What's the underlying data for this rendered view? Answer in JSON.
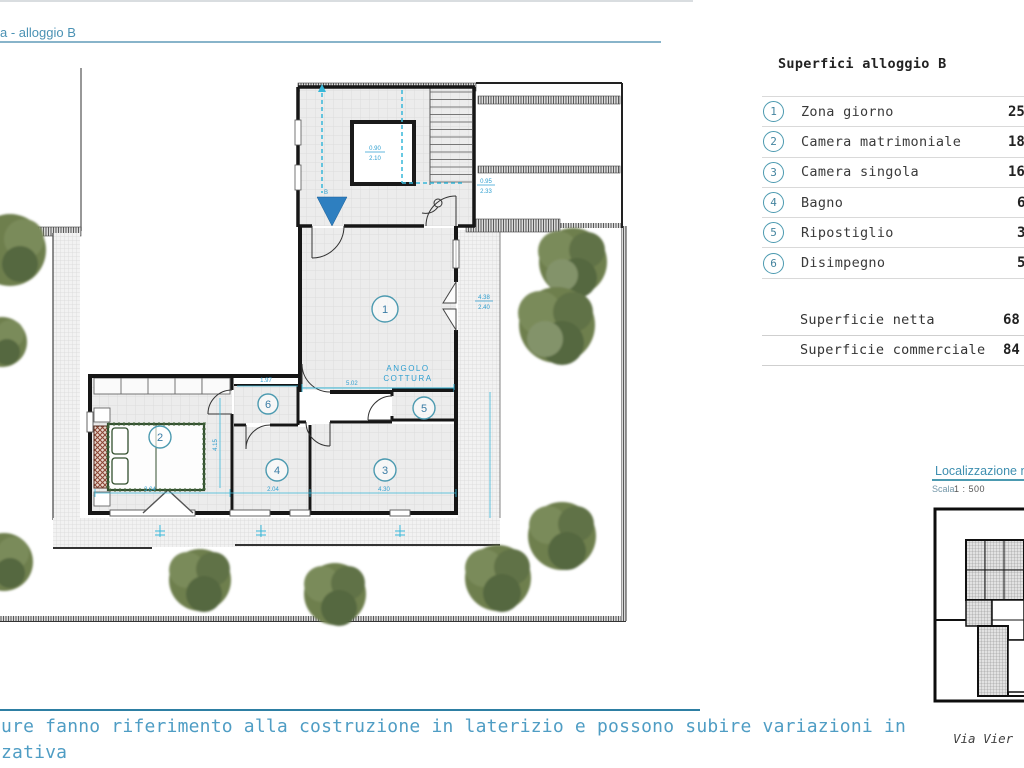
{
  "page": {
    "title": "a - alloggio B"
  },
  "panel": {
    "title": "Superfici alloggio B",
    "rows": [
      {
        "num": "1",
        "label": "Zona giorno",
        "value": "25"
      },
      {
        "num": "2",
        "label": "Camera matrimoniale",
        "value": "18"
      },
      {
        "num": "3",
        "label": "Camera singola",
        "value": "16"
      },
      {
        "num": "4",
        "label": "Bagno",
        "value": "6"
      },
      {
        "num": "5",
        "label": "Ripostiglio",
        "value": "3"
      },
      {
        "num": "6",
        "label": "Disimpegno",
        "value": "5"
      }
    ],
    "totals": [
      {
        "label": "Superficie netta",
        "value": "68"
      },
      {
        "label": "Superficie commerciale",
        "value": "84"
      }
    ]
  },
  "localization": {
    "title": "Localizzazione n",
    "scale_label": "Scala",
    "scale_value": "1 : 500"
  },
  "footer": {
    "line1": "ure fanno riferimento alla costruzione in laterizio e possono subire variazioni in",
    "line2": "zativa",
    "address": "Via Vier"
  },
  "plan": {
    "rooms": [
      "1",
      "2",
      "3",
      "4",
      "5",
      "6"
    ],
    "labels": {
      "angolo_line1": "ANGOLO",
      "angolo_line2": "COTTURA",
      "entrance": "B"
    },
    "dims": {
      "elev_top": "0.90",
      "elev_bot": "2.10",
      "right1_top": "0.95",
      "right1_bot": "2.33",
      "right2_top": "4.38",
      "right2_bot": "2.40",
      "d_502": "5.02",
      "d_197": "1.97",
      "d_304": "3.04",
      "d_204": "2.04",
      "d_430": "4.30",
      "v_415": "4.15"
    }
  },
  "colors": {
    "accent_teal": "#4a93b8",
    "dim_blue": "#2f9fd0",
    "cyan": "#36b7d9",
    "tree_green": "#6e7f4e",
    "wall_black": "#1a1a1a",
    "entrance_blue": "#2e7fc0"
  }
}
